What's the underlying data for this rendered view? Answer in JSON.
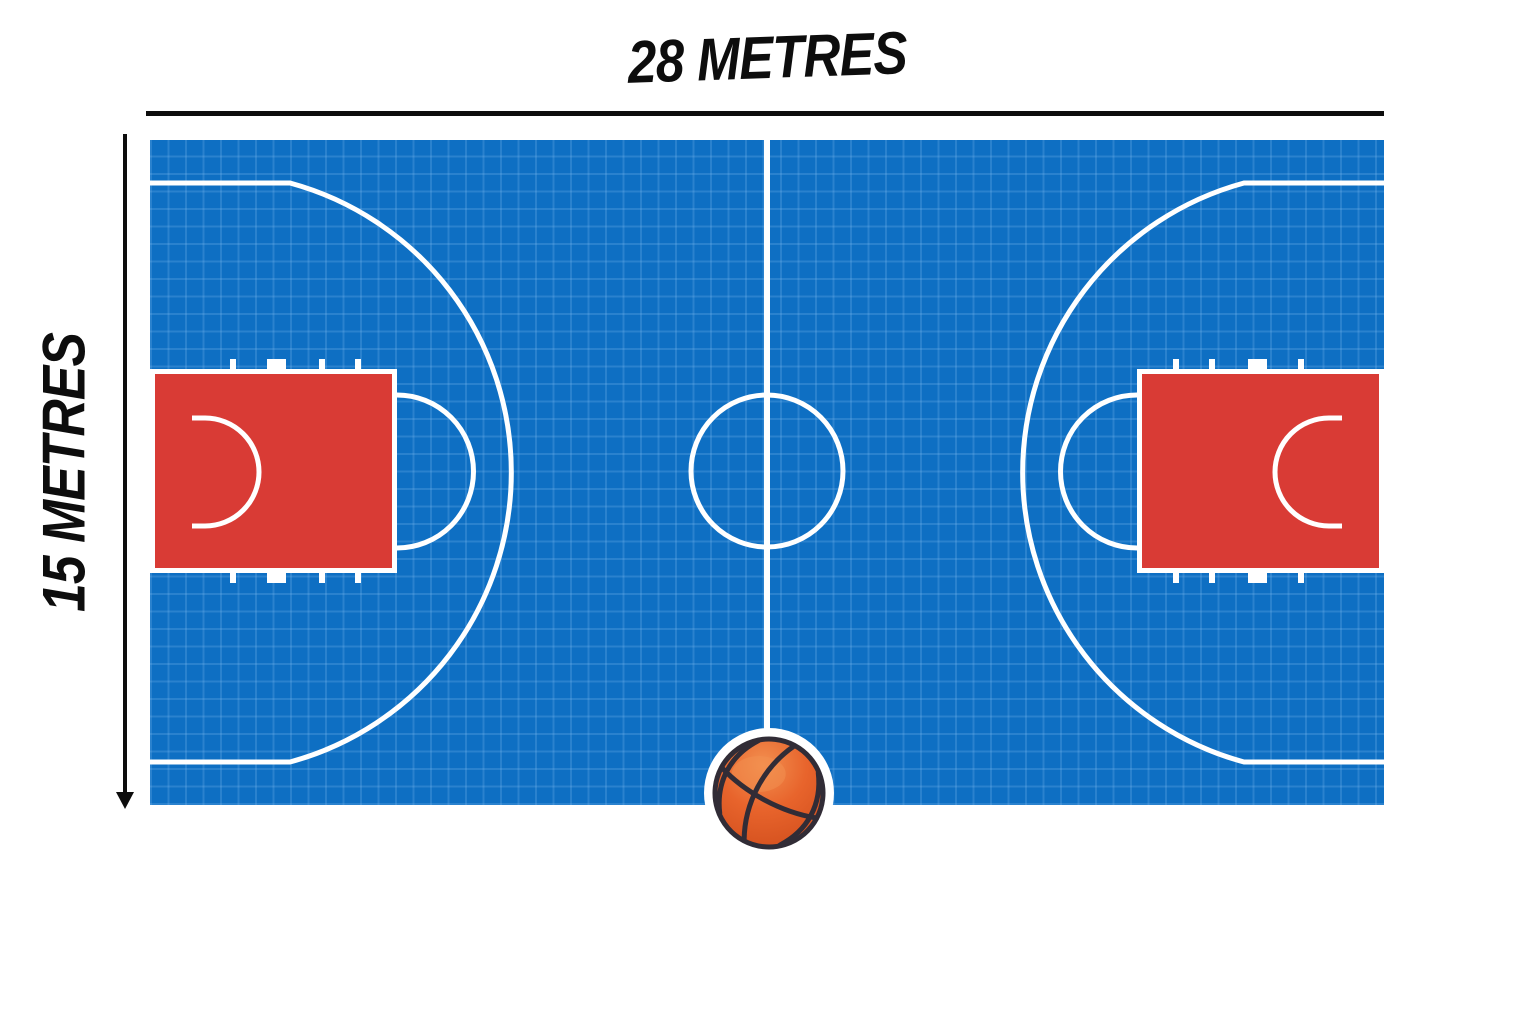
{
  "theme": {
    "page-bg": "#ffffff",
    "ink": "#0d0d0d",
    "court-blue": "#0e6fc3",
    "grid-line": "rgba(140,195,245,0.22)",
    "paint-red": "#d93b35",
    "line-white": "#ffffff",
    "ball-orange": "#e8642c",
    "ball-orange-light": "#f29050",
    "ball-orange-dark": "#cf4c1b",
    "ball-seam": "#312c36",
    "ball-halo": "#ffffff"
  },
  "diagram": {
    "court_width_label": "28 METRES",
    "court_height_label": "15 METRES",
    "court_width_value_m": 28,
    "court_height_value_m": 15
  },
  "ball": {
    "icon": "basketball-icon"
  }
}
